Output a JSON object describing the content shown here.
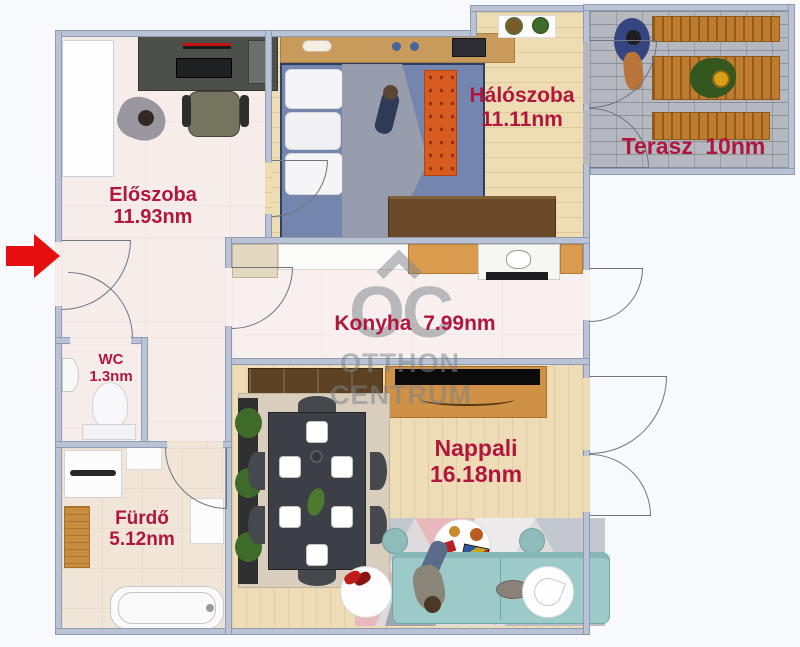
{
  "rooms": [
    {
      "id": "eloszoba",
      "name": "Előszoba",
      "area": "11.93nm"
    },
    {
      "id": "haloszoba",
      "name": "Hálószoba",
      "area": "11.11nm"
    },
    {
      "id": "terasz",
      "name": "Terasz",
      "area": "10nm"
    },
    {
      "id": "konyha",
      "name": "Konyha",
      "area": "7.99nm"
    },
    {
      "id": "wc",
      "name": "WC",
      "area": "1.3nm"
    },
    {
      "id": "furdo",
      "name": "Fürdő",
      "area": "5.12nm"
    },
    {
      "id": "nappali",
      "name": "Nappali",
      "area": "16.18nm"
    }
  ],
  "watermark": {
    "logo": "OC",
    "line1": "OTTHON",
    "line2": "CENTRUM"
  },
  "colors": {
    "room_label": "#b1173e",
    "walls": "#b9c3d5",
    "entrance_arrow": "#e60f0f",
    "terrace_floor": "#b5b8be",
    "wood_floor": "#eedcb3",
    "tile_floor": "#f6edea",
    "watermark_gray": "#7d828a"
  }
}
